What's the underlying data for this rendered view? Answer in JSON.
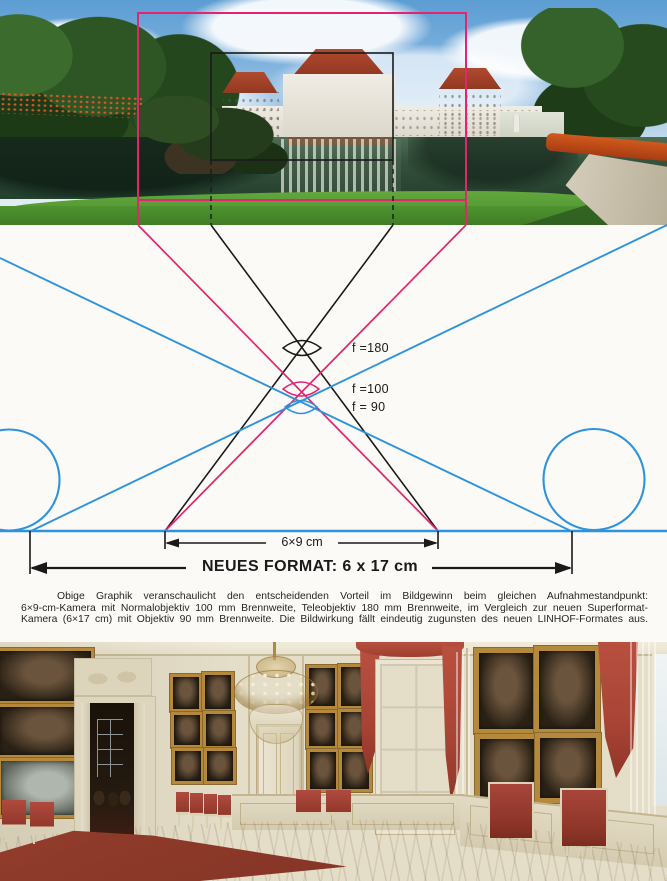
{
  "diagram": {
    "f180": "f =180",
    "f100": "f =100",
    "f90": "f = 90",
    "small_format": "6×9 cm",
    "large_format": "NEUES FORMAT: 6 x 17 cm"
  },
  "caption": {
    "line1": "Obige Graphik veranschaulicht den entscheidenden Vorteil im Bildgewinn beim gleichen Aufnahmestandpunkt:",
    "line2": "6×9-cm-Kamera mit Normalobjektiv 100 mm Brennweite, Teleobjektiv 180 mm Brennweite, im Vergleich zur neuen Superformat-",
    "line3": "Kamera (6×17 cm) mit Objektiv 90 mm Brennweite. Die Bildwirkung fällt eindeutig zugunsten des neuen LINHOF-Formates aus."
  },
  "palette": {
    "magenta": "#E3256F",
    "blue": "#2E93DD",
    "ink": "#1A1A1A",
    "caption_ink": "#262626",
    "page_bg": "#FBFAF6"
  }
}
